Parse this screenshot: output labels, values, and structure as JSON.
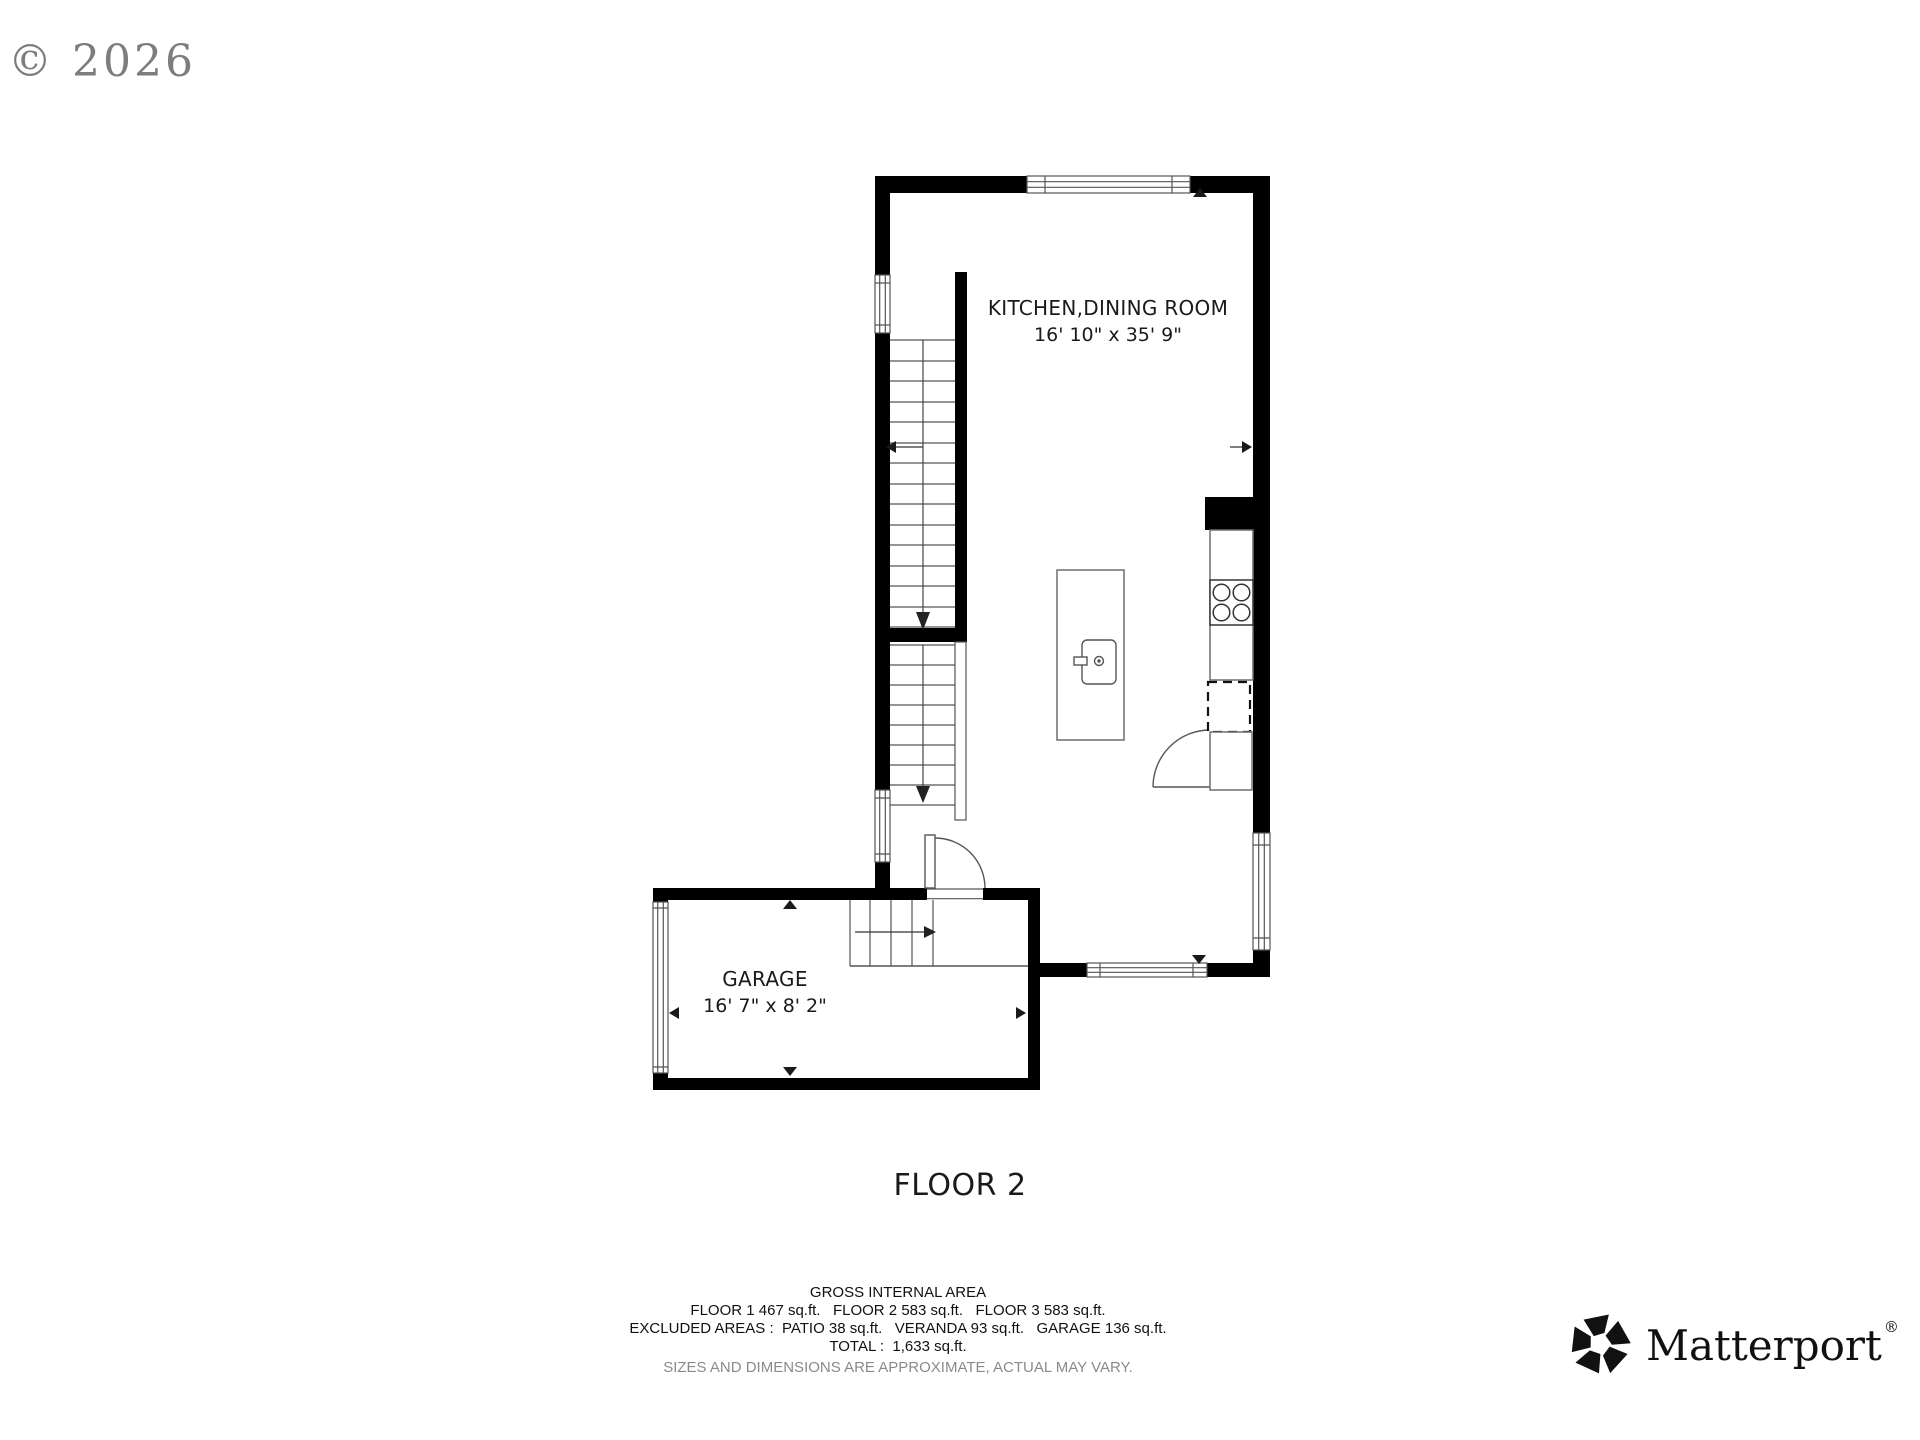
{
  "copyright": "© 2026",
  "floor_plan": {
    "rooms": [
      {
        "name": "KITCHEN,DINING ROOM",
        "dimensions": "16' 10\" x 35' 9\""
      },
      {
        "name": "GARAGE",
        "dimensions": "16' 7\" x 8' 2\""
      }
    ],
    "floor_label": "FLOOR 2"
  },
  "footer": {
    "title": "GROSS INTERNAL AREA",
    "floors_line": "FLOOR 1 467 sq.ft.   FLOOR 2 583 sq.ft.   FLOOR 3 583 sq.ft.",
    "excluded_line": "EXCLUDED AREAS :  PATIO 38 sq.ft.   VERANDA 93 sq.ft.   GARAGE 136 sq.ft.",
    "total_line": "TOTAL :  1,633 sq.ft.",
    "disclaimer": "SIZES AND DIMENSIONS ARE APPROXIMATE, ACTUAL MAY VARY."
  },
  "branding": {
    "logo_text": "Matterport",
    "registered": "®"
  },
  "colors": {
    "wall": "#000000",
    "line": "#555555",
    "text": "#1a1a1a",
    "muted": "#8a8a8a"
  }
}
